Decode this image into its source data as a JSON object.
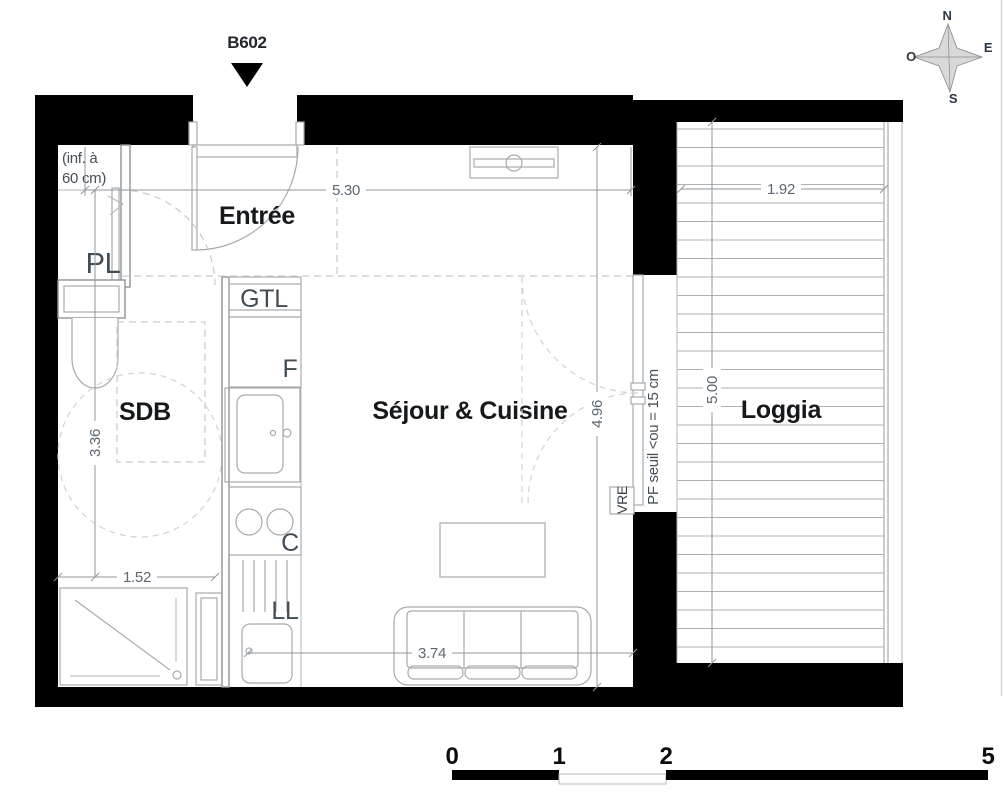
{
  "title": {
    "unit": "B602"
  },
  "compass": {
    "n": "N",
    "e": "E",
    "s": "S",
    "o": "O"
  },
  "rooms": {
    "entree": "Entrée",
    "sdb": "SDB",
    "sejour": "Séjour & Cuisine",
    "loggia": "Loggia",
    "placard": "PL"
  },
  "fixtures": {
    "gtl": "GTL",
    "fridge": "F",
    "cooktop": "C",
    "washer": "LL",
    "shutter": "VRE"
  },
  "notes": {
    "low_ceiling_line1": "(inf. à",
    "low_ceiling_line2": "60 cm)",
    "threshold": "PF seuil <ou = 15 cm"
  },
  "dimensions": {
    "entree_width_m": "5.30",
    "loggia_width_m": "1.92",
    "loggia_depth_m": "5.00",
    "sejour_depth_m": "4.96",
    "sejour_width_m": "3.74",
    "sdb_depth_m": "3.36",
    "sdb_width_m": "1.52"
  },
  "scale_bar": {
    "tick0": "0",
    "tick1": "1",
    "tick2": "2",
    "tick5": "5"
  },
  "colors": {
    "wall": "#000000",
    "fixture_line": "#a7abae",
    "dimension_text": "#5d6771",
    "room_label": "#16191c",
    "sub_label": "#424c54"
  }
}
